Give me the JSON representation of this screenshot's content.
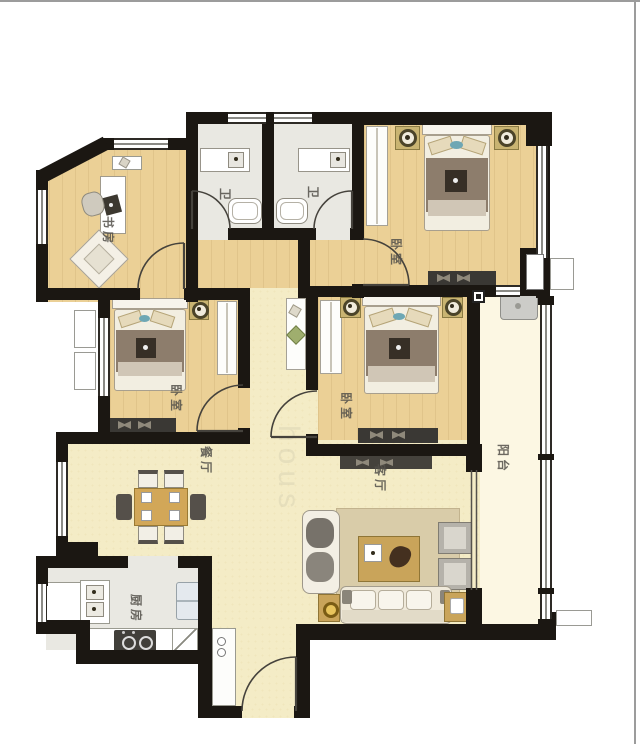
{
  "plan": {
    "title": "apartment-floor-plan",
    "rooms": [
      {
        "id": "study",
        "label": "书房"
      },
      {
        "id": "bath-1",
        "label": "卫"
      },
      {
        "id": "bath-2",
        "label": "卫"
      },
      {
        "id": "bedroom-master",
        "label": "卧室"
      },
      {
        "id": "bedroom-left",
        "label": "卧室"
      },
      {
        "id": "bedroom-middle",
        "label": "卧室"
      },
      {
        "id": "dining",
        "label": "餐厅"
      },
      {
        "id": "living",
        "label": "客厅"
      },
      {
        "id": "balcony",
        "label": "阳台"
      },
      {
        "id": "kitchen",
        "label": "厨房"
      }
    ],
    "watermark": "hous",
    "colors": {
      "wall": "#1b1712",
      "wood_floor": "#ebd096",
      "cream_floor": "#f4ecc6",
      "tile_floor": "#e9e8e2",
      "balcony_floor": "#fcf7e3",
      "accent_tan": "#c9a45a",
      "blanket": "#8d7d6c",
      "page_border": "#9c9c9c"
    }
  }
}
